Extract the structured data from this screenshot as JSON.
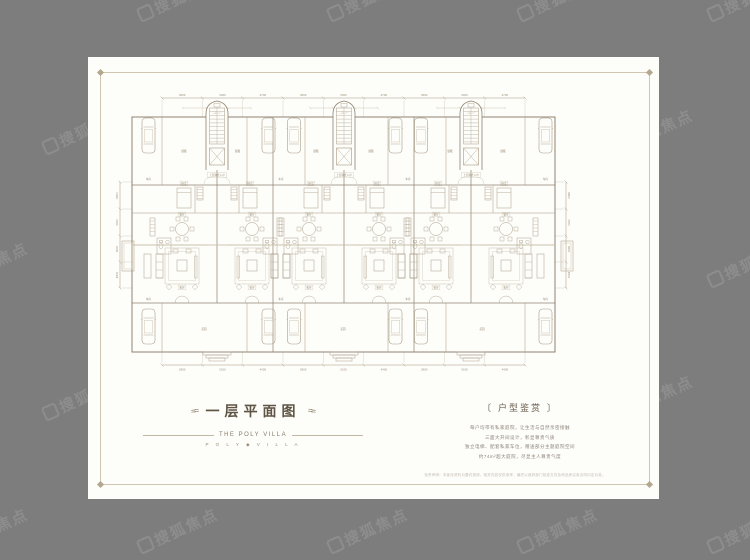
{
  "page": {
    "background": "#7d7d7d",
    "paper": "#fdfdfa",
    "frame_color": "#cfc5b2",
    "wall_color": "#8f8272",
    "line_color": "#a89a84",
    "furniture_color": "#ab9d87",
    "light_color": "#c6bba6",
    "label_color": "#9a8c76",
    "title_color": "#5f5544"
  },
  "watermark": {
    "text": "搜狐焦点"
  },
  "title_block": {
    "title": "一层平面图",
    "subtitle": "THE POLY VILLA",
    "tagline": "P O L Y ◆ V I L L A"
  },
  "info_block": {
    "heading": "〔 户型鉴赏 〕",
    "lines": [
      "每户均带有私家庭院，让生活与自然亲密接触",
      "三面大开间设计，彰显尊贵气质",
      "独立电梯、配套私家车位，赠送部分主题庭院空间",
      "约74m²超大庭院，尽显主人尊贵气度"
    ]
  },
  "disclaimer": "免责声明：本宣传资料为要约邀请，相关内容仅供参考，最终以政府部门批准文件及商品房买卖合同约定为准。",
  "plan": {
    "labels": {
      "bedroom": "卧室",
      "dining": "餐厅",
      "living": "客厅",
      "garage": "车库",
      "storage": "储藏",
      "garden": "花园",
      "entry": "上层复式入户",
      "tower": "二层入户"
    },
    "dim_top": [
      "3600",
      "5400",
      "4700",
      "3600",
      "5400",
      "4700",
      "3600",
      "5400",
      "4700"
    ],
    "dim_bottom": [
      "3900",
      "5100",
      "4400",
      "3900",
      "5100",
      "4400",
      "3900",
      "5100",
      "4400"
    ],
    "dim_left": [
      "6600",
      "3300",
      "3600",
      "4800"
    ],
    "dim_right": [
      "6600",
      "3300",
      "3600",
      "4800"
    ]
  }
}
